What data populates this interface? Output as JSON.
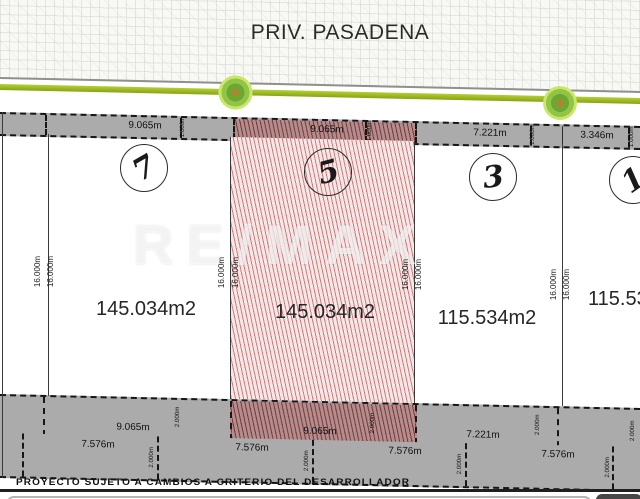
{
  "street": {
    "name": "PRIV. PASADENA"
  },
  "watermark": {
    "brand": "RE/MAX"
  },
  "colors": {
    "grass_green": "#9cb822",
    "strip_gray": "#ababab",
    "lot_hatch_pink": "#f8e7e7",
    "lot_hatch_line": "#c66a6a",
    "highlight_strip_hatch": "#b48e8e"
  },
  "lots": [
    {
      "number": "7",
      "area": "145.034m2",
      "highlighted": false
    },
    {
      "number": "5",
      "area": "145.034m2",
      "highlighted": true
    },
    {
      "number": "3",
      "area": "115.534m2",
      "highlighted": false
    },
    {
      "number": "1",
      "area": "115.53",
      "highlighted": false
    }
  ],
  "measurements": {
    "front": [
      "9.065m",
      "9.065m",
      "7.221m",
      "3.346m"
    ],
    "front_gap": "1.000m",
    "depth": "16.000m",
    "rear_upper": [
      "9.065m",
      "9.065m",
      "7.221m"
    ],
    "rear_upper_setback": "2.000m",
    "rear_lower": [
      "7.576m",
      "7.576m",
      "7.576m",
      "7.576m"
    ],
    "rear_lower_setback": "2.000m"
  },
  "footer": {
    "disclaimer": "PROYECTO SUJETO A CAMBIOS A CRITERIO DEL DESARROLLADOR"
  }
}
